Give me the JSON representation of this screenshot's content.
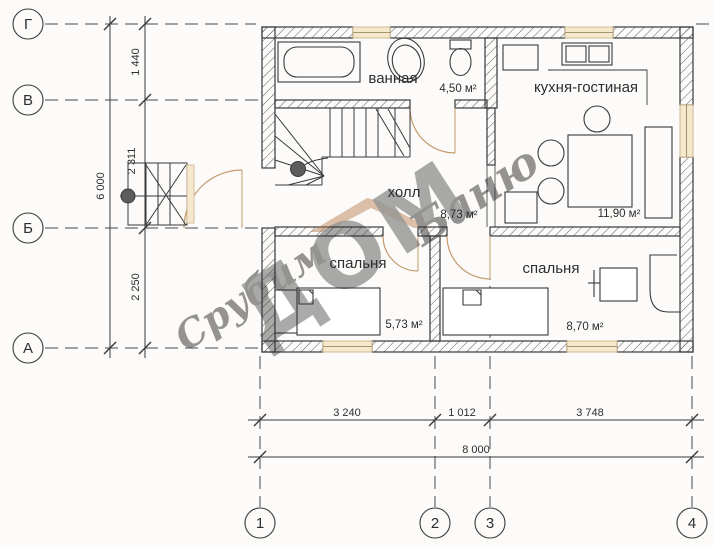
{
  "axes": {
    "rows": [
      {
        "label": "Г"
      },
      {
        "label": "В"
      },
      {
        "label": "Б"
      },
      {
        "label": "А"
      }
    ],
    "cols": [
      {
        "label": "1"
      },
      {
        "label": "2"
      },
      {
        "label": "3"
      },
      {
        "label": "4"
      }
    ]
  },
  "dims": {
    "v_total": "6 000",
    "v_segments": [
      "1 440",
      "2 311",
      "2 250"
    ],
    "h_total": "8 000",
    "h_segments": [
      "3 240",
      "1 012",
      "3 748"
    ]
  },
  "rooms": {
    "bathroom": {
      "name": "ванная",
      "area": "4,50 м²"
    },
    "kitchen": {
      "name": "кухня-гостиная",
      "area": "11,90 м²"
    },
    "hall": {
      "name": "холл",
      "area": "8,73 м²"
    },
    "bedroom1": {
      "name": "спальня",
      "area": "5,73 м²"
    },
    "bedroom2": {
      "name": "спальня",
      "area": "8,70 м²"
    }
  },
  "watermark": {
    "word1": "Срубим",
    "word2": "ДОМ",
    "word3": "Баню"
  },
  "colors": {
    "line": "#3a3a3a",
    "window_fill": "#f6e8cd",
    "window_frame": "#c9b48a",
    "door_arc": "#c49a6c",
    "watermark": "#bd8257"
  }
}
